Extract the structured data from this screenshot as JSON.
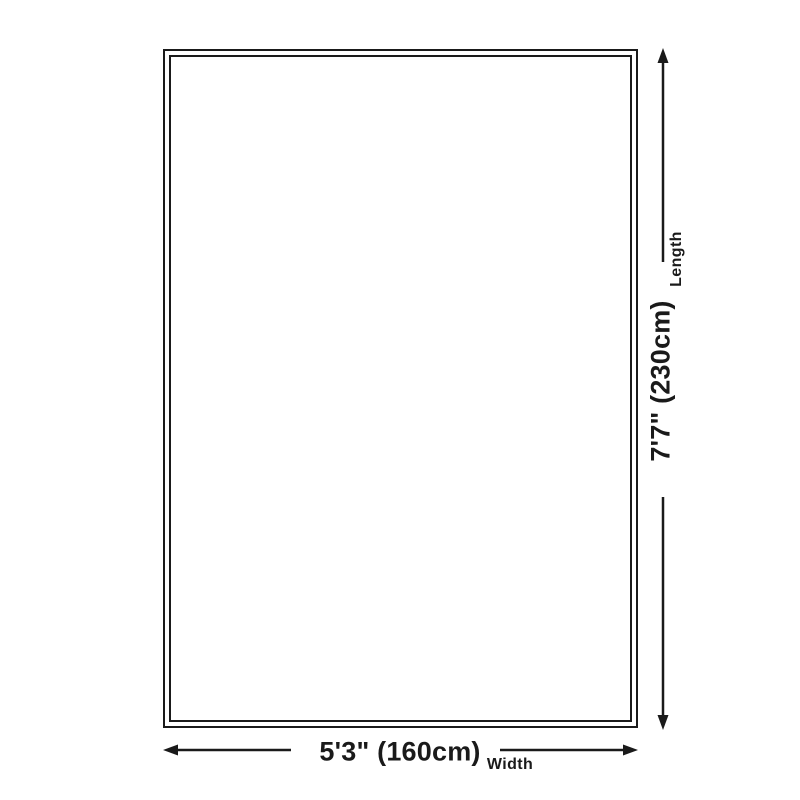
{
  "diagram": {
    "type": "product-dimension-diagram",
    "width_value": "5'3\" (160cm)",
    "width_label": "Width",
    "length_value": "7'7\" (230cm)",
    "length_label": "Length",
    "colors": {
      "line": "#1a1a1a",
      "background": "#ffffff"
    },
    "icons": {
      "width_arrow": "double-headed-horizontal-arrow",
      "length_arrow": "double-headed-vertical-arrow"
    }
  }
}
